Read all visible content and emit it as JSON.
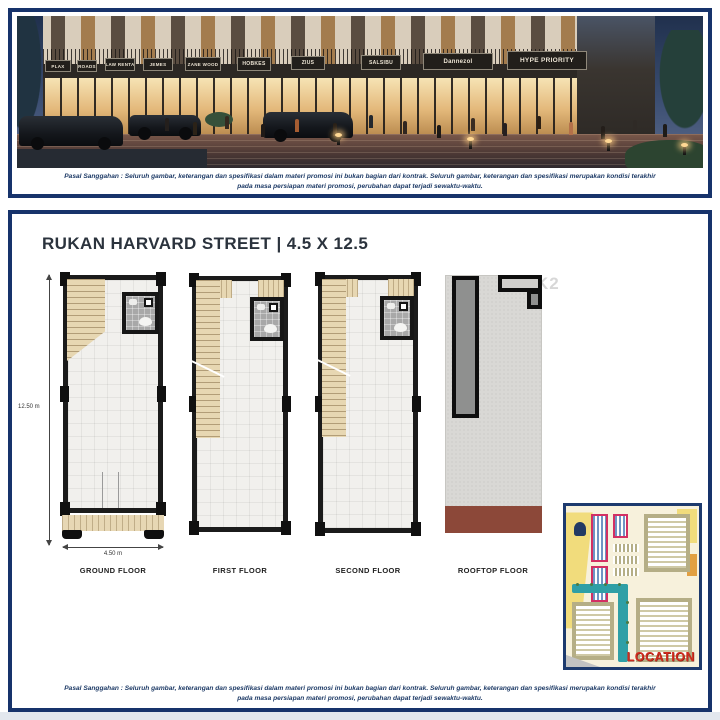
{
  "colors": {
    "frame_navy": "#17336b",
    "disclaimer_navy": "#1d3a66",
    "plan_wall_black": "#1b1b1b",
    "stair_beige": "#e7d7b2",
    "rooftop_brown": "#8c4839",
    "location_red": "#d02b1e",
    "map_highlight_red": "#d32f63",
    "map_canal_teal": "#2f9fa6",
    "map_yellow": "#f1dc7c"
  },
  "hero": {
    "storefront_signs": [
      "PLAX",
      "ROADS",
      "LAW RENTA",
      "JEMES",
      "ZANE WOOD",
      "HOBKES",
      "ZIUS",
      "SALSIBU",
      "Dannezol",
      "HYPE PRIORITY"
    ],
    "disclaimer": [
      "Pasal Sanggahan : Seluruh gambar, keterangan dan spesifikasi dalam materi promosi ini bukan bagian dari kontrak. Seluruh gambar, keterangan dan spesifikasi merupakan kondisi terakhir",
      "pada masa persiapan materi promosi, perubahan dapat terjadi sewaktu-waktu."
    ]
  },
  "plans": {
    "title": "RUKAN HARVARD STREET | 4.5 X 12.5",
    "watermark": "u di PIK2",
    "dimensions": {
      "height": "12.50 m",
      "width": "4.50 m"
    },
    "floors": [
      {
        "label": "GROUND FLOOR"
      },
      {
        "label": "FIRST FLOOR"
      },
      {
        "label": "SECOND FLOOR"
      },
      {
        "label": "ROOFTOP FLOOR"
      }
    ]
  },
  "map": {
    "label": "LOCATION"
  },
  "footer": {
    "disclaimer": [
      "Pasal Sanggahan : Seluruh gambar, keterangan dan spesifikasi dalam materi promosi ini bukan bagian dari kontrak. Seluruh gambar, keterangan dan spesifikasi merupakan kondisi terakhir",
      "pada masa persiapan materi promosi, perubahan dapat terjadi sewaktu-waktu."
    ]
  }
}
